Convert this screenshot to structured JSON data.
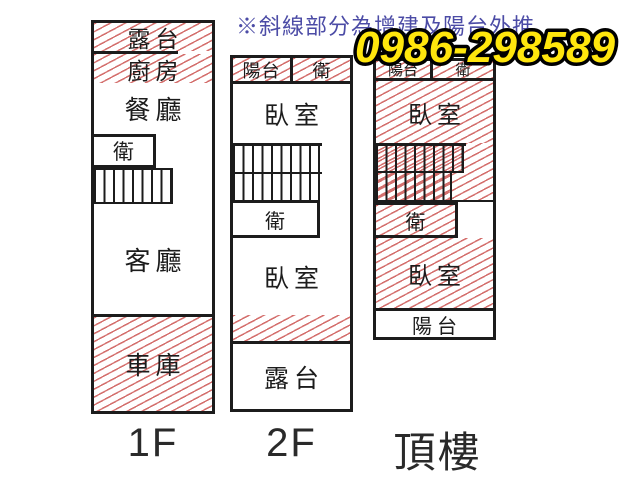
{
  "note": {
    "text": "※斜線部分為增建及陽台外推"
  },
  "phone": {
    "number": "0986-298589"
  },
  "colors": {
    "background": "#ffffff",
    "wall": "#1c1c1c",
    "hatch": "#d4706e",
    "note_text": "#4c4ca6",
    "phone_fill": "#ffe60d",
    "phone_outline": "#000000"
  },
  "legend_meaning": "hatched-areas-mark-additions-and-balcony-extensions",
  "floors": {
    "f1": {
      "label": "1F",
      "terrace": "露台",
      "kitchen": "廚房",
      "dining": "餐廳",
      "bath": "衛",
      "living": "客廳",
      "garage": "車庫"
    },
    "f2": {
      "label": "2F",
      "balcony": "陽台",
      "bath_top": "衛",
      "bedroom_upper": "臥室",
      "bath_mid": "衛",
      "bedroom_lower": "臥室",
      "terrace": "露台"
    },
    "roof": {
      "label": "頂樓",
      "balcony_top": "陽台",
      "bath_top": "衛",
      "bedroom_upper": "臥室",
      "bath_mid": "衛",
      "bedroom_lower": "臥室",
      "balcony_bottom": "陽台"
    }
  }
}
